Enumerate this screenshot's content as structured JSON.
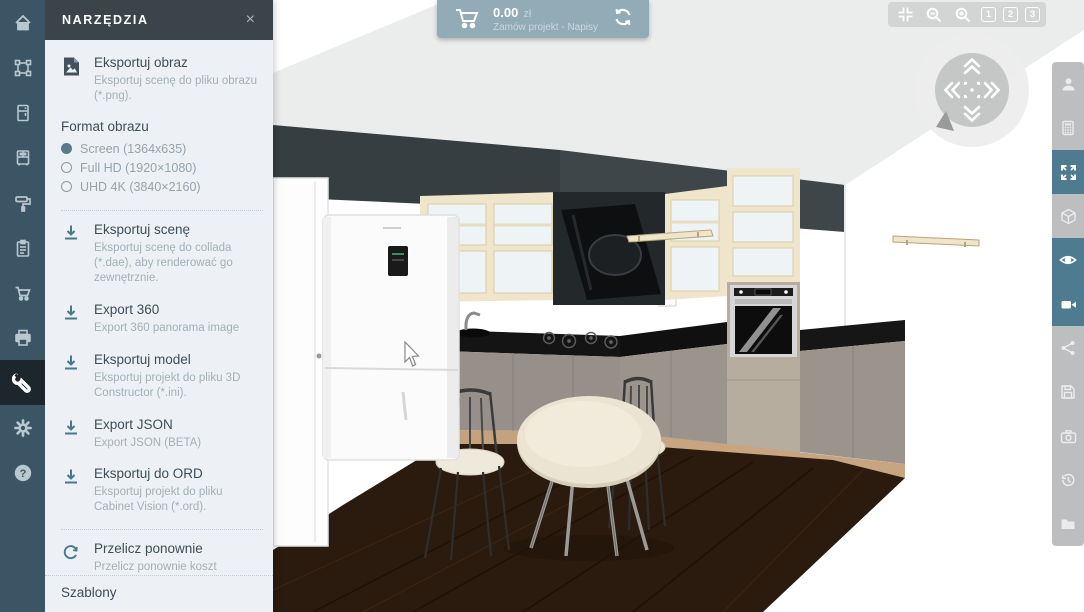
{
  "colors": {
    "accent_teal": "#47798e",
    "left_rail_bg": "#3b5565",
    "left_rail_active_bg": "#1d262c",
    "panel_bg": "#edf1f5",
    "panel_header_bg": "#3a4449",
    "top_bar_bg": "#93aab7",
    "view_controls_bg": "#d3d4d4",
    "right_rail_bg": "#bdbebf",
    "right_rail_active_bg": "#4e7b90"
  },
  "icons": {
    "close_glyph": "×",
    "help_glyph": "?"
  },
  "left_sidebar": {
    "items": [
      {
        "icon": "home-icon"
      },
      {
        "icon": "select-transform-icon"
      },
      {
        "icon": "tall-cabinet-icon"
      },
      {
        "icon": "base-cabinet-icon"
      },
      {
        "icon": "paint-roller-icon"
      },
      {
        "icon": "clipboard-icon"
      },
      {
        "icon": "cart-icon"
      },
      {
        "icon": "printer-icon"
      },
      {
        "icon": "wrench-icon",
        "active": true
      },
      {
        "icon": "gear-icon"
      },
      {
        "icon": "help-icon"
      }
    ]
  },
  "tools_panel": {
    "title": "NARZĘDZIA",
    "export_items": [
      {
        "icon": "export-image-icon",
        "title": "Eksportuj obraz",
        "desc": "Eksportuj scenę do pliku obrazu (*.png)."
      },
      {
        "icon": "download-icon",
        "title": "Eksportuj scenę",
        "desc": "Eksportuj scenę do collada (*.dae), aby renderować go zewnętrznie."
      },
      {
        "icon": "download-icon",
        "title": "Export 360",
        "desc": "Export 360 panorama image"
      },
      {
        "icon": "download-icon",
        "title": "Eksportuj model",
        "desc": "Eksportuj projekt do pliku 3D Constructor (*.ini)."
      },
      {
        "icon": "download-icon",
        "title": "Export JSON",
        "desc": "Export JSON (BETA)"
      },
      {
        "icon": "download-icon",
        "title": "Eksportuj do ORD",
        "desc": "Eksportuj projekt do pliku Cabinet Vision (*.ord)."
      },
      {
        "icon": "recalculate-icon",
        "title": "Przelicz ponownie",
        "desc": "Przelicz ponownie koszt projektu"
      }
    ],
    "format": {
      "label": "Format obrazu",
      "options": [
        {
          "label": "Screen (1364x635)",
          "selected": true
        },
        {
          "label": "Full HD (1920×1080)",
          "selected": false
        },
        {
          "label": "UHD 4K (3840×2160)",
          "selected": false
        }
      ]
    },
    "footer": "Szablony"
  },
  "top_bar": {
    "price": "0.00",
    "currency": "zł",
    "subtitle": "Zamów projekt - Napisy"
  },
  "view_controls": {
    "presets": [
      "1",
      "2",
      "3"
    ]
  },
  "right_sidebar": {
    "items": [
      {
        "icon": "person-icon"
      },
      {
        "icon": "calculator-icon"
      },
      {
        "icon": "fullscreen-icon",
        "active": true
      },
      {
        "icon": "cube-3d-icon"
      },
      {
        "icon": "eye-icon",
        "active": true
      },
      {
        "icon": "video-camera-icon",
        "active": true
      },
      {
        "icon": "share-icon"
      },
      {
        "icon": "save-icon"
      },
      {
        "icon": "photo-camera-icon"
      },
      {
        "icon": "history-icon"
      },
      {
        "icon": "folder-icon"
      }
    ]
  }
}
